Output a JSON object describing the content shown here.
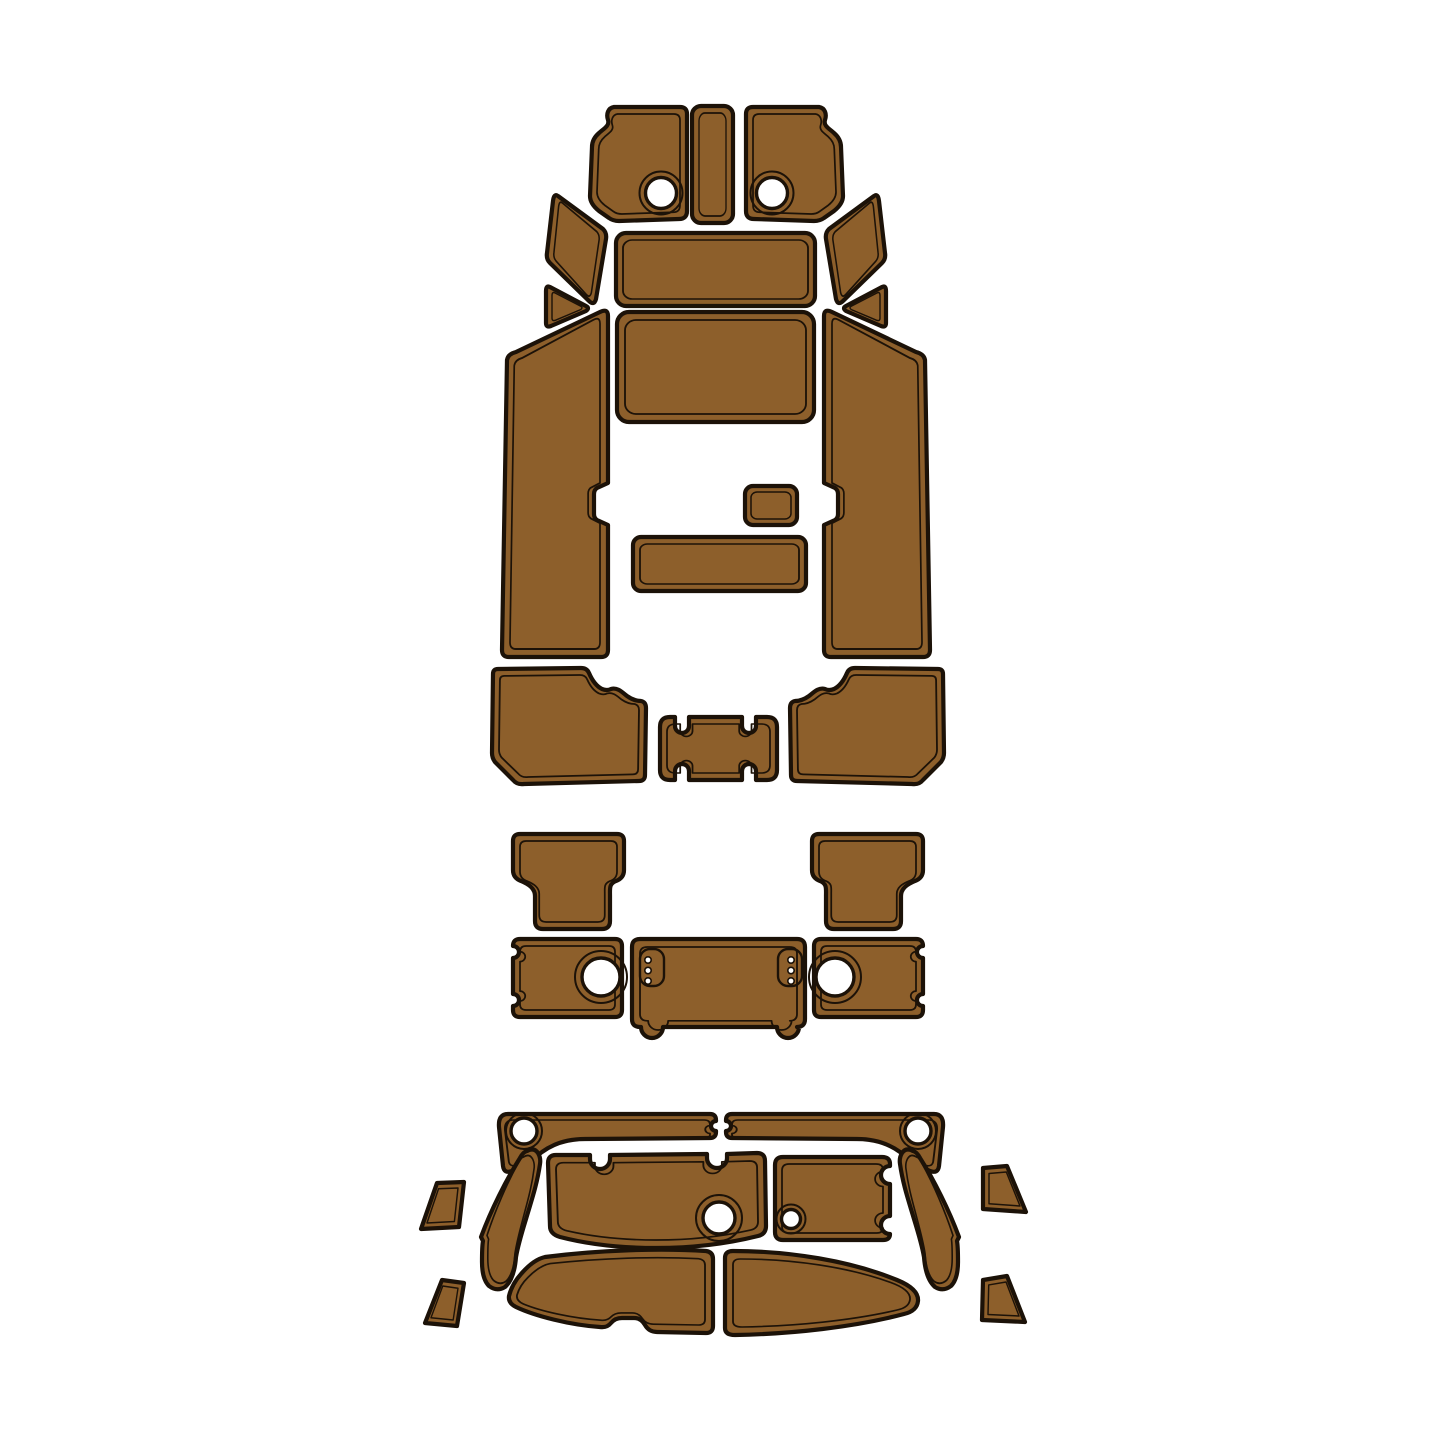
{
  "canvas": {
    "width": 1445,
    "height": 1445,
    "background_color": "#ffffff"
  },
  "artwork": {
    "kind": "boat EVA foam decking pad cut template",
    "pad_color": "#8d5f2b",
    "outline_color": "#1c1208",
    "hole_color": "#ffffff",
    "sections": [
      {
        "name": "cockpit-floor-group",
        "pieces": [
          "bow-pad-port",
          "bow-center-strip",
          "bow-pad-starboard",
          "upper-wedge-port",
          "upper-center-pad",
          "upper-wedge-starboard",
          "corner-triangle-port",
          "corner-triangle-starboard",
          "main-center-pad",
          "side-panel-port",
          "side-panel-starboard",
          "small-hatch-pad",
          "step-pad",
          "rear-corner-pad-port",
          "rear-latch-pad",
          "rear-corner-pad-starboard"
        ]
      },
      {
        "name": "mid-deck-group",
        "pieces": [
          "t-pad-port",
          "t-pad-starboard",
          "hatch-box-port",
          "center-hatch-pad",
          "hatch-box-starboard"
        ]
      },
      {
        "name": "swim-platform-group",
        "pieces": [
          "gunwale-strip-port",
          "gunwale-strip-starboard",
          "trim-quad-upper-port",
          "trim-quad-lower-port",
          "trim-quad-upper-starboard",
          "trim-quad-lower-starboard",
          "wing-pad-port",
          "wing-pad-starboard",
          "platform-pad-port",
          "platform-pad-starboard",
          "transom-pad-port",
          "transom-pad-starboard"
        ]
      }
    ]
  }
}
